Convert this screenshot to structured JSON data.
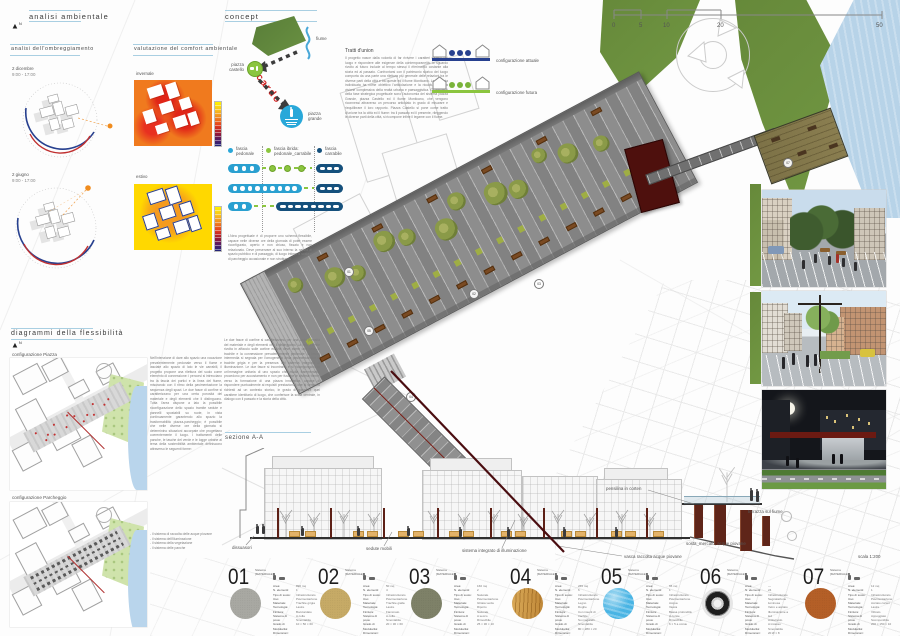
{
  "headings": {
    "analisi": "analisi ambientale",
    "ombreggiamento": "analisi dell'ombreggiamento",
    "comfort": "valutazione del comfort ambientale",
    "concept": "concept",
    "flessibilita": "diagrammi della flessibilità",
    "config_piazza": "configurazione Piazza",
    "config_parcheggio": "configurazione Parcheggio",
    "sezione": "sezione A-A"
  },
  "sun_diagrams": [
    {
      "date": "2 dicembre",
      "hours": "9:00 - 17:00"
    },
    {
      "date": "2 giugno",
      "hours": "9:00 - 17:00"
    }
  ],
  "comfort_maps": [
    {
      "label": "invernale"
    },
    {
      "label": "estivo"
    }
  ],
  "concept": {
    "fiume": "fiume",
    "piazza_castello": "piazza\ncastello",
    "cardo": "cardo",
    "piazza_grande": "piazza\ngrande",
    "essay_title": "Tratti d'union",
    "essay_body": "Il progetto nasce dalla volontà di far rivivere i caratteri salienti del luogo e rispondere alle esigenze della contemporaneità: lo sguardo rivolto al futuro include al tempo stesso il riferimento costante alla storia ed al passato. Confrontarsi con il patrimonio storico del luogo comporta da una parte una rilettura più generale delle relazioni tra le diverse parti della città e tra queste ed il fiume Monticano. La strategia individuata ha come obiettivo l'articolazione e la ricucitura di una visione complessiva della realtà urbana e paesaggistica. Gli elementi della fase strategica progettuale sono l'autonomia del sistema piazza Grande, piazza Castello ed il fiume Monticano, che vengono riconnessi attraverso un percorso articolato in grado di misurare e riequilibrare il loro rapporto. Piazza Castello si pone come tratto d'unione tra la città ed il fiume: tra il passato ed il presente, rileggendo le diverse parti della città, si ricompone infine il legame con il fiume.",
    "config_attuale": "configurazione attuale",
    "config_futura": "configurazione futura",
    "legend": [
      {
        "label": "fascia\npedonale"
      },
      {
        "label": "fascia ibrida:\npedonale_carrabile"
      },
      {
        "label": "fascia\ncarrabile"
      }
    ],
    "note": "L'idea progettuale è di proporre uno schema flessibile, capace nelle diverse ore della giornata di poter essere riconfigurato, aperto e non chiuso, fissato e non relazionato. Deve preservare al suo interno la natura di spazio pubblico e di passaggio, di luogo intimo di sosta e di parcheggio occasionale e non strutturato."
  },
  "scalebar": {
    "ticks": [
      "0",
      "5",
      "10",
      "20",
      "50"
    ]
  },
  "flex_text": {
    "colA": "Nell'intenzione di dare allo spazio una vocazione prevalentemente pedonale verso il fiume e lasciate allo spazio di lato le vie carrabili, il progetto propone una rilettura del suolo come elemento di connessione: i percorsi si intrecciano tra la fascia dei portici e la linea del fiume, misurando con il ritmo della pavimentazione la sequenza degli spazi. Le due fasce di confine si caratterizzano per una certa porosità del materiale e degli elementi che li distinguono. Tutta l'area dispone a lato la possibile riconfigurazione dello spazio tramite sedute e pannelli spostabili su ruote, in vista continuamente garantendo allo spazio la trasformabilità piazza-parcheggio; è possibile che nelle diverse ore della giornata si determinino situazioni accorpate che progettano coerentemente il luogo. I trattamenti delle panche, le tasche del verde e le logge urbane al tema della sostenibilità ambientale definiscono attraverso le seguenti forme:",
    "colB": "Le due fasce di confine si caratterizzano per una certa porosità del materiale e degli elementi che li distinguono. La fascia limite rivolta in affaccio sulle cortine edilizie deve avere una base di trachite e la connessione prevalentemente pedonale; la fascia intermedia si segnala per l'omogeneità della pavimentazione in trachite grigia e per la presenza del sistema integrato di illuminazione. Le due fasce si incontrano e si ricompongono in un'immagine unitaria di uno spazio che risulta frammentato: procedono per accostamento e non per fusione le diverse forme, verso la formazione di una piazza innovativa, capace di rispondere puntualmente ai requisiti prestazionali che si vengono richiesti ad un contesto storico, in grado di garantire quel carattere identitario di luogo, che conferisce la scala centrale, in dialogo con il passato e la storia della città.",
    "bullets": "- il sistema di raccolta delle acque piovane\n- il sistema dell'illuminazione\n- il sistema della vegetazione\n- il sistema delle panche"
  },
  "sezione": {
    "dissuasori": "dissuasori",
    "sedute": "sedute mobili",
    "illuminazione": "sistema integrato di illuminazione",
    "pensilina": "pensilina in corten",
    "terrazza": "terrazza sul fiume",
    "vasca": "vasca raccolta acque piovane",
    "sosta": "sosta_mercato, acque piovane",
    "scala": "scala 1:200"
  },
  "plan": {
    "markers": [
      "01",
      "02",
      "03",
      "04",
      "05",
      "07"
    ]
  },
  "materials": {
    "labels": "Area:\nN. elementi:\nTipo di suolo:\nUso:\nMateriale:\nTecnologia:\nFinitura:\nSistema di posa:\nGrado di Modularità:\nDimensioni:",
    "items": [
      {
        "num": "01",
        "sys": "Sistema\n[MATERIALE]",
        "values": "890 mq\n1\nInfrastrutturato\nPavimentazione\nTrachite grigia\nLastre\nBocciardato\nA colla\nSmontabile\n10 × 50 × 60",
        "cls": "stone-grey",
        "color": "#a8a8a2"
      },
      {
        "num": "02",
        "sys": "Sistema\n[MATERIALE]",
        "values": "50 mq\n4\nInfrastrutturato\nPavimentazione\nTrachite gialla\nLastre\nFiammato\nA colla\nSmontabile\n20 × 30 × 60",
        "cls": "stone-gold",
        "color": "#c6aa66"
      },
      {
        "num": "03",
        "sys": "Sistema\n[MATERIALE]",
        "values": "160 mq\n2\nNaturale\nPavimentazione\nGhiaia verde\nRiporto\nNaturale\nA secco\nRimovibile\n25 × 30 × 10",
        "cls": "stone-green",
        "color": "#7e8168"
      },
      {
        "num": "04",
        "sys": "Sistema\n[MATERIALE]",
        "values": "265 mq\n6\nInfrastrutturato\nPavimentazione\nLegno\nDoghe\nCon inserti di trachite\nSu magatelli\nSmontabile\n80 × 280 × 20",
        "cls": "wood",
        "color": "#c9953f"
      },
      {
        "num": "05",
        "sys": "Sistema\n[MATERIALE]",
        "values": "65 mq\n1\nInfrastrutturato\nPavimentazione\nAcqua\nVasca\nBassa profondità\nA corsie\nRimovibile\n6 × 5 a corsie",
        "cls": "water",
        "color": "#49b4e4"
      },
      {
        "num": "06",
        "sys": "Sistema\n[MATERIALE]",
        "values": "—\n24\nInfrastrutturato\nSegnalazione luminosa\nVetro e acciaio\nIlluminazione a led\nAntiscivolo\nA incasso\nSmontabile\n20 Ø × 8",
        "cls": "led",
        "color": "#e8e8e8"
      },
      {
        "num": "07",
        "sys": "Sistema\n[MATERIALE]",
        "values": "12 mq\n1\nInfrastrutturato\nPavimentazione\nAcciaio corten\nLastre\nVibrato\nAppoggiato\nScomponibile\n200 × 150 × 10",
        "cls": "corten",
        "color": "#b45f27"
      }
    ]
  }
}
